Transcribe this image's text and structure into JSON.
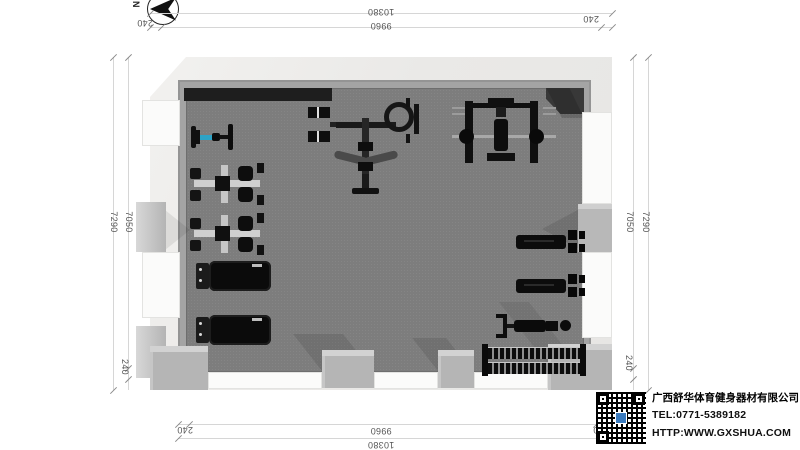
{
  "compass": {
    "label": "N"
  },
  "dimensions": {
    "overall_width": "10380",
    "inner_width": "9960",
    "overall_depth": "7290",
    "inner_depth": "7050",
    "wall_thickness": "240"
  },
  "company": {
    "name": "广西舒华体育健身器材有限公司",
    "tel": "TEL:0771-5389182",
    "website": "HTTP:WWW.GXSHUA.COM"
  },
  "colors": {
    "floor": "#7d7d7d",
    "wall_top": "#a4a4a4",
    "wall_face": "#edecea",
    "window": "#fbfbfa",
    "dark_strip": "#1e1e1e",
    "equipment_black": "#0f0f0f",
    "accent_blue": "#2ea3c6",
    "dim_line": "#d6d6d6",
    "dim_text": "#555555",
    "qr_logo_blue": "#3a7bbf"
  },
  "icons": {
    "north-compass-icon": "black needle arrow pointing left inside circle",
    "qr-code-icon": "qr code with blue center logo"
  },
  "equipment": [
    {
      "id": "exercise-bike",
      "label": "exercise bike with blue frame"
    },
    {
      "id": "strength-station-1",
      "label": "dual-seat strength machine"
    },
    {
      "id": "strength-station-2",
      "label": "dual-seat strength machine"
    },
    {
      "id": "treadmill-1",
      "label": "treadmill"
    },
    {
      "id": "treadmill-2",
      "label": "treadmill"
    },
    {
      "id": "multi-station-gym",
      "label": "multi-station cable gym"
    },
    {
      "id": "smith-machine",
      "label": "smith machine with barbell and bench"
    },
    {
      "id": "plate-machine-1",
      "label": "plate loaded machine"
    },
    {
      "id": "plate-machine-2",
      "label": "plate loaded machine"
    },
    {
      "id": "flat-bench",
      "label": "flat bench"
    },
    {
      "id": "dumbbell-rack",
      "label": "two-tier dumbbell rack"
    }
  ]
}
